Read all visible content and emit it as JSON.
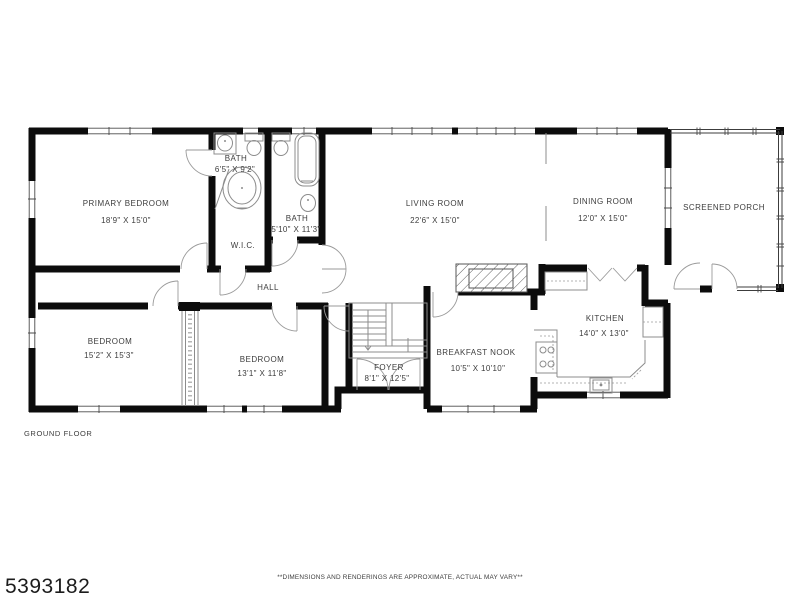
{
  "meta": {
    "listing_id": "5393182",
    "floor_label": "GROUND FLOOR",
    "disclaimer": "**DIMENSIONS AND RENDERINGS ARE APPROXIMATE, ACTUAL MAY VARY**"
  },
  "rooms": {
    "primary_bedroom": {
      "name": "PRIMARY BEDROOM",
      "dims": "18'9\" X 15'0\""
    },
    "bath_upper": {
      "name": "BATH",
      "dims": "6'5\" X 9'2\""
    },
    "bath_lower": {
      "name": "BATH",
      "dims": "5'10\" X 11'3\""
    },
    "wic": {
      "name": "W.I.C."
    },
    "hall": {
      "name": "HALL"
    },
    "living_room": {
      "name": "LIVING ROOM",
      "dims": "22'6\" X 15'0\""
    },
    "dining_room": {
      "name": "DINING ROOM",
      "dims": "12'0\" X 15'0\""
    },
    "screened_porch": {
      "name": "SCREENED PORCH"
    },
    "bedroom_left": {
      "name": "BEDROOM",
      "dims": "15'2\" X 15'3\""
    },
    "bedroom_middle": {
      "name": "BEDROOM",
      "dims": "13'1\" X 11'8\""
    },
    "foyer": {
      "name": "FOYER",
      "dims": "8'1\" X 12'5\""
    },
    "breakfast_nook": {
      "name": "BREAKFAST NOOK",
      "dims": "10'5\" X 10'10\""
    },
    "kitchen": {
      "name": "KITCHEN",
      "dims": "14'0\" X 13'0\""
    }
  },
  "colors": {
    "wall": "#0c0c0c",
    "text": "#3d3d3d",
    "fixture": "#8c8c8c",
    "background": "#ffffff"
  }
}
